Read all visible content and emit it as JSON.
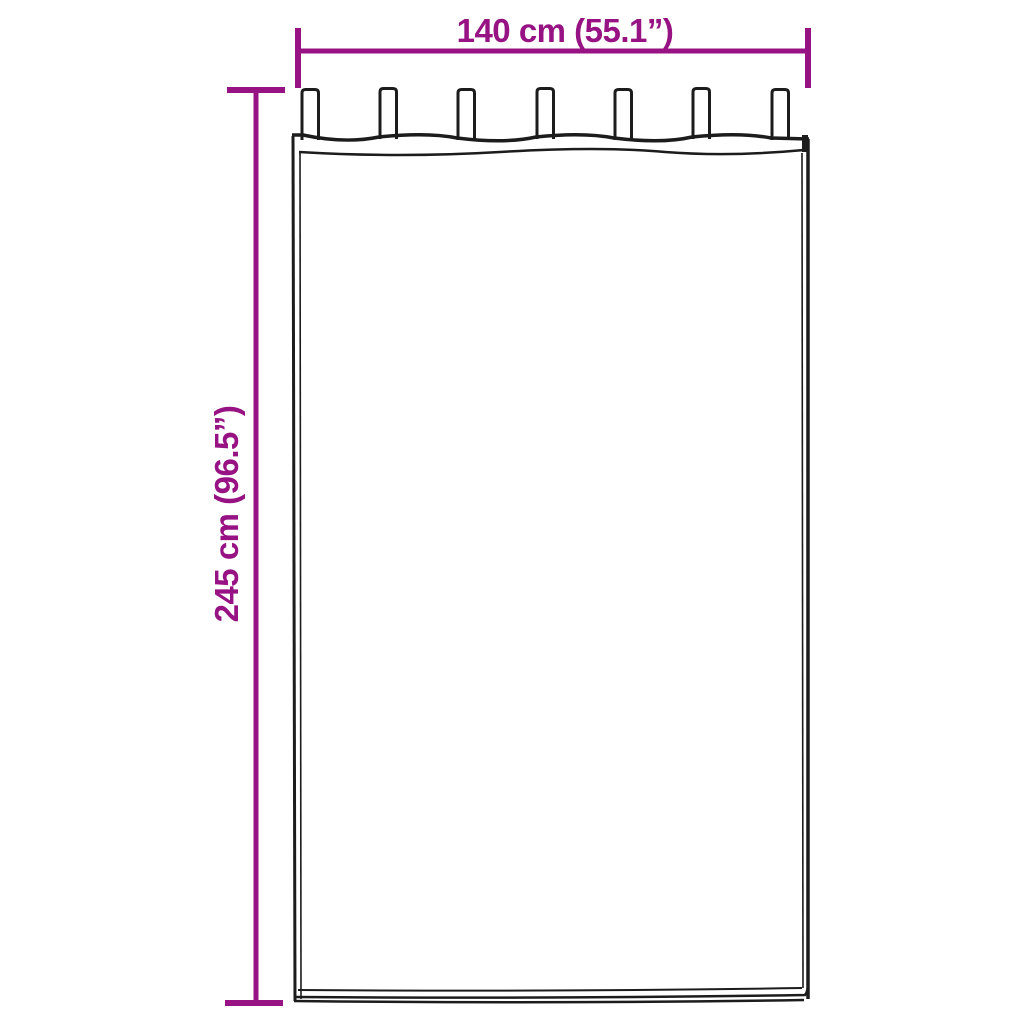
{
  "page": {
    "background_color": "#ffffff"
  },
  "diagram": {
    "kind": "product-dimension-diagram",
    "subject": "tab-top-curtain-sketch",
    "accent_color": "#971283",
    "outline_color": "#1c1c1c",
    "tab_count": 7,
    "width_dimension": {
      "label": "140 cm (55.1”)"
    },
    "height_dimension": {
      "label": "245 cm (96.5”)"
    }
  }
}
